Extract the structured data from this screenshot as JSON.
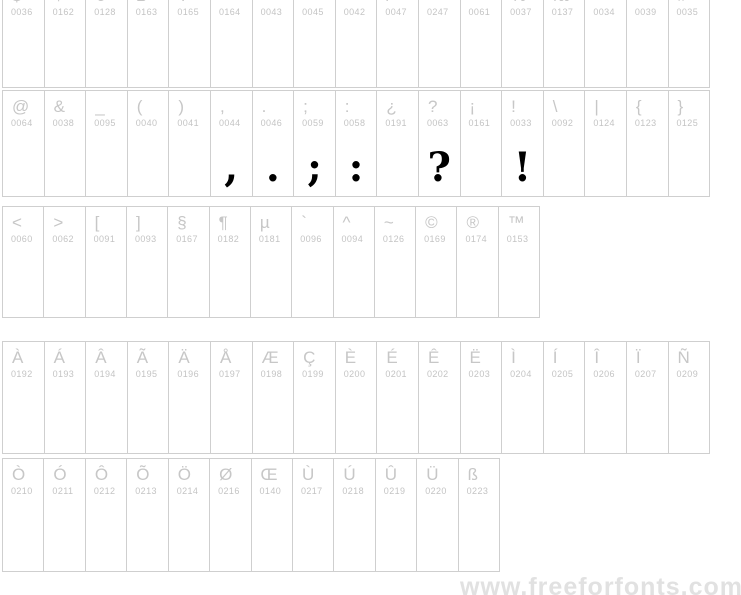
{
  "watermark": {
    "text": "www.freeforfonts.com"
  },
  "colors": {
    "background": "#ffffff",
    "reference_char": "#c7c7c7",
    "code_text": "#c4c4c4",
    "cell_border": "#cfcfcf",
    "rendered_glyph": "#000000",
    "watermark_text": "#e1e1e1"
  },
  "rows": [
    {
      "name": "currency-and-math-symbols",
      "cells": [
        {
          "char": "$",
          "code": "0036"
        },
        {
          "char": "¢",
          "code": "0162"
        },
        {
          "char": "€",
          "code": "0128"
        },
        {
          "char": "£",
          "code": "0163"
        },
        {
          "char": "¥",
          "code": "0165"
        },
        {
          "char": "¤",
          "code": "0164"
        },
        {
          "char": "+",
          "code": "0043"
        },
        {
          "char": "-",
          "code": "0045"
        },
        {
          "char": "*",
          "code": "0042"
        },
        {
          "char": "/",
          "code": "0047"
        },
        {
          "char": "÷",
          "code": "0247"
        },
        {
          "char": "=",
          "code": "0061"
        },
        {
          "char": "%",
          "code": "0037"
        },
        {
          "char": "‰",
          "code": "0137"
        },
        {
          "char": "\"",
          "code": "0034"
        },
        {
          "char": "'",
          "code": "0039"
        },
        {
          "char": "#",
          "code": "0035"
        }
      ]
    },
    {
      "name": "punctuation-symbols",
      "cells": [
        {
          "char": "@",
          "code": "0064"
        },
        {
          "char": "&",
          "code": "0038"
        },
        {
          "char": "_",
          "code": "0095"
        },
        {
          "char": "(",
          "code": "0040"
        },
        {
          "char": ")",
          "code": "0041"
        },
        {
          "char": ",",
          "code": "0044",
          "rendered": true
        },
        {
          "char": ".",
          "code": "0046",
          "rendered": true
        },
        {
          "char": ";",
          "code": "0059",
          "rendered": true
        },
        {
          "char": ":",
          "code": "0058",
          "rendered": true
        },
        {
          "char": "¿",
          "code": "0191"
        },
        {
          "char": "?",
          "code": "0063",
          "rendered": true
        },
        {
          "char": "¡",
          "code": "0161"
        },
        {
          "char": "!",
          "code": "0033",
          "rendered": true
        },
        {
          "char": "\\",
          "code": "0092"
        },
        {
          "char": "|",
          "code": "0124"
        },
        {
          "char": "{",
          "code": "0123"
        },
        {
          "char": "}",
          "code": "0125"
        }
      ]
    },
    {
      "name": "brackets-and-special-symbols",
      "cells": [
        {
          "char": "<",
          "code": "0060"
        },
        {
          "char": ">",
          "code": "0062"
        },
        {
          "char": "[",
          "code": "0091"
        },
        {
          "char": "]",
          "code": "0093"
        },
        {
          "char": "§",
          "code": "0167"
        },
        {
          "char": "¶",
          "code": "0182"
        },
        {
          "char": "µ",
          "code": "0181"
        },
        {
          "char": "`",
          "code": "0096"
        },
        {
          "char": "^",
          "code": "0094"
        },
        {
          "char": "~",
          "code": "0126"
        },
        {
          "char": "©",
          "code": "0169"
        },
        {
          "char": "®",
          "code": "0174"
        },
        {
          "char": "™",
          "code": "0153"
        }
      ]
    },
    {
      "name": "accented-uppercase-a-to-n",
      "cells": [
        {
          "char": "À",
          "code": "0192"
        },
        {
          "char": "Á",
          "code": "0193"
        },
        {
          "char": "Â",
          "code": "0194"
        },
        {
          "char": "Ã",
          "code": "0195"
        },
        {
          "char": "Ä",
          "code": "0196"
        },
        {
          "char": "Å",
          "code": "0197"
        },
        {
          "char": "Æ",
          "code": "0198"
        },
        {
          "char": "Ç",
          "code": "0199"
        },
        {
          "char": "È",
          "code": "0200"
        },
        {
          "char": "É",
          "code": "0201"
        },
        {
          "char": "Ê",
          "code": "0202"
        },
        {
          "char": "Ë",
          "code": "0203"
        },
        {
          "char": "Ì",
          "code": "0204"
        },
        {
          "char": "Í",
          "code": "0205"
        },
        {
          "char": "Î",
          "code": "0206"
        },
        {
          "char": "Ï",
          "code": "0207"
        },
        {
          "char": "Ñ",
          "code": "0209"
        }
      ]
    },
    {
      "name": "accented-uppercase-o-to-ss",
      "cells": [
        {
          "char": "Ò",
          "code": "0210"
        },
        {
          "char": "Ó",
          "code": "0211"
        },
        {
          "char": "Ô",
          "code": "0212"
        },
        {
          "char": "Õ",
          "code": "0213"
        },
        {
          "char": "Ö",
          "code": "0214"
        },
        {
          "char": "Ø",
          "code": "0216"
        },
        {
          "char": "Œ",
          "code": "0140"
        },
        {
          "char": "Ù",
          "code": "0217"
        },
        {
          "char": "Ú",
          "code": "0218"
        },
        {
          "char": "Û",
          "code": "0219"
        },
        {
          "char": "Ü",
          "code": "0220"
        },
        {
          "char": "ß",
          "code": "0223"
        }
      ]
    }
  ]
}
